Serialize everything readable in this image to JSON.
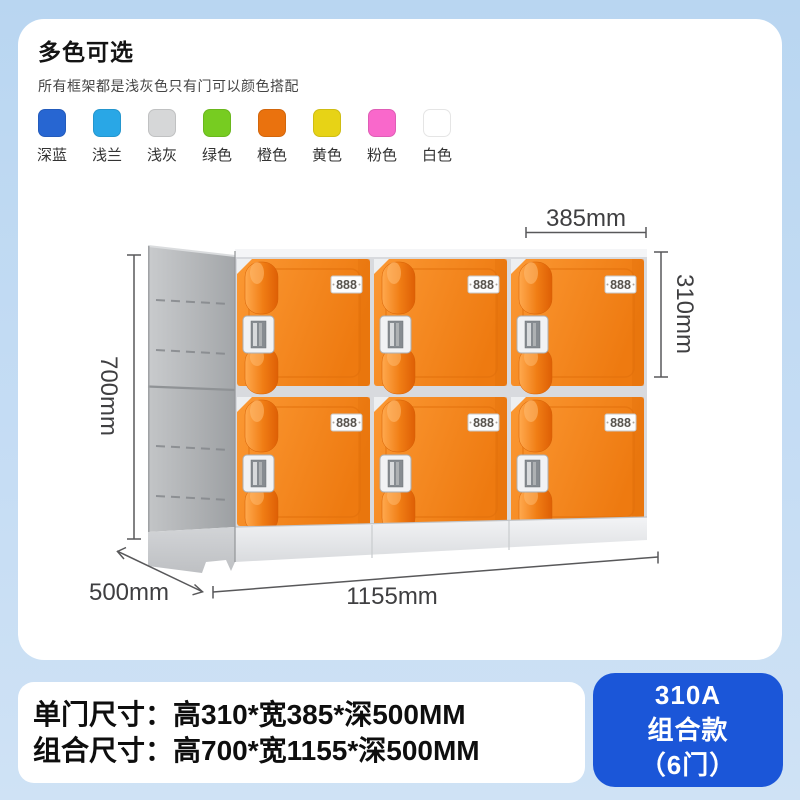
{
  "page": {
    "background": "#c6ddf4",
    "card_background": "#ffffff"
  },
  "colors": {
    "title": "多色可选",
    "subtitle": "所有框架都是浅灰色只有门可以颜色搭配",
    "items": [
      {
        "label": "深蓝",
        "hex": "#2766d2"
      },
      {
        "label": "浅兰",
        "hex": "#29a7e6"
      },
      {
        "label": "浅灰",
        "hex": "#d6d7d8"
      },
      {
        "label": "绿色",
        "hex": "#77cc21"
      },
      {
        "label": "橙色",
        "hex": "#ea720e"
      },
      {
        "label": "黄色",
        "hex": "#e7d316"
      },
      {
        "label": "粉色",
        "hex": "#f968cb"
      },
      {
        "label": "白色",
        "hex": "#ffffff"
      }
    ]
  },
  "locker": {
    "door_label": "888",
    "door_color": "#f08018",
    "frame_color": "#b6b8ba",
    "dimensions": {
      "door_width": "385mm",
      "door_height": "310mm",
      "total_height": "700mm",
      "depth": "500mm",
      "total_width": "1155mm"
    }
  },
  "specs": {
    "line1": "单门尺寸：高310*宽385*深500MM",
    "line2": "组合尺寸：高700*宽1155*深500MM"
  },
  "model": {
    "code": "310A",
    "name": "组合款",
    "doors": "（6门）",
    "badge_color": "#1b56d8"
  }
}
